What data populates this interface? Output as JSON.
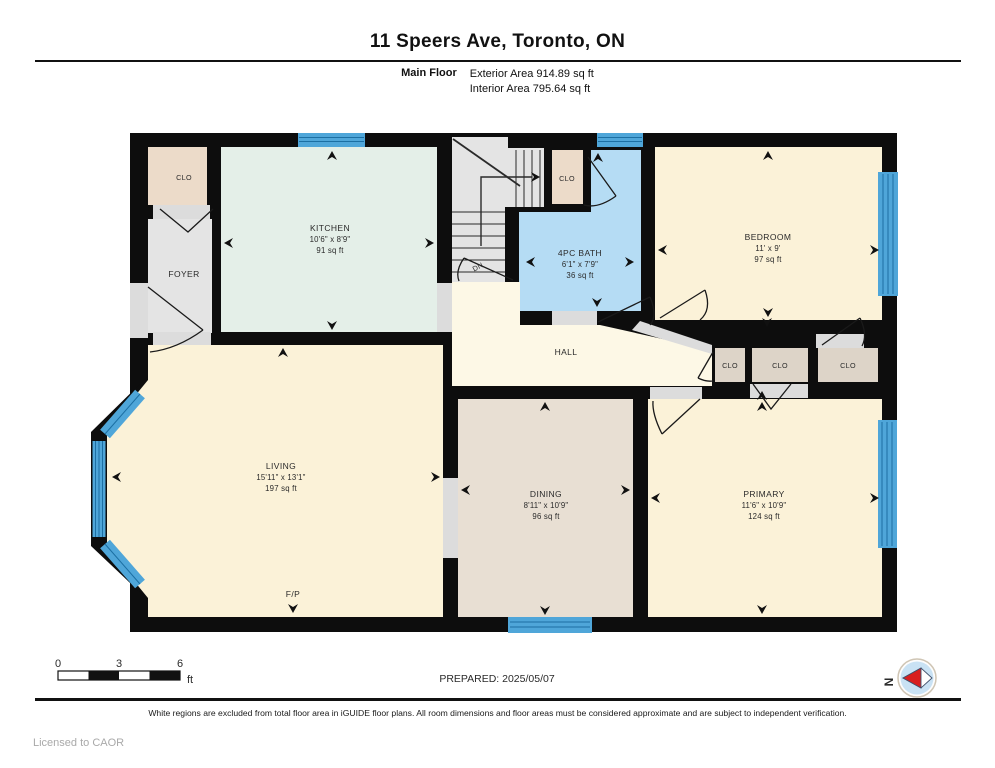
{
  "header": {
    "title": "11 Speers Ave, Toronto, ON",
    "floor_label": "Main Floor",
    "exterior_area": "Exterior Area 914.89 sq ft",
    "interior_area": "Interior Area 795.64 sq ft"
  },
  "plan": {
    "rooms": {
      "kitchen": {
        "name": "KITCHEN",
        "dims": "10'6\" x 8'9\"",
        "area": "91 sq ft"
      },
      "bath": {
        "name": "4PC BATH",
        "dims": "6'1\" x 7'9\"",
        "area": "36 sq ft"
      },
      "bedroom": {
        "name": "BEDROOM",
        "dims": "11' x 9'",
        "area": "97 sq ft"
      },
      "living": {
        "name": "LIVING",
        "dims": "15'11\" x 13'1\"",
        "area": "197 sq ft"
      },
      "dining": {
        "name": "DINING",
        "dims": "8'11\" x 10'9\"",
        "area": "96 sq ft"
      },
      "primary": {
        "name": "PRIMARY",
        "dims": "11'6\" x 10'9\"",
        "area": "124 sq ft"
      },
      "foyer": {
        "name": "FOYER"
      },
      "hall": {
        "name": "HALL"
      }
    },
    "labels": {
      "closet": "CLO",
      "fireplace": "F/P",
      "stairs_down": "DN"
    },
    "colors": {
      "wall": "#0d0d0d",
      "cream": "#fbf2d8",
      "hall_cream": "#fdf8e6",
      "mint": "#e4efe8",
      "bath_blue": "#b5dcf4",
      "dining_tan": "#e8dfd3",
      "closet_tan": "#ecdbc9",
      "closet_gray": "#ddd4c8",
      "floor_gray": "#e4e4e4",
      "opening_gray": "#dcdcdc",
      "window_fill": "#4fa6d9",
      "window_line": "#1c6fa3",
      "compass_blue": "#c9e2f4",
      "compass_red": "#d81f1f"
    }
  },
  "scale_bar": {
    "tick0": "0",
    "tick1": "3",
    "tick2": "6",
    "unit": "ft"
  },
  "prepared": "PREPARED: 2025/05/07",
  "compass": {
    "north": "N"
  },
  "footer": {
    "disclaimer": "White regions are excluded from total floor area in iGUIDE floor plans. All room dimensions and floor areas must be considered approximate and are subject to independent verification.",
    "license": "Licensed to CAOR"
  }
}
